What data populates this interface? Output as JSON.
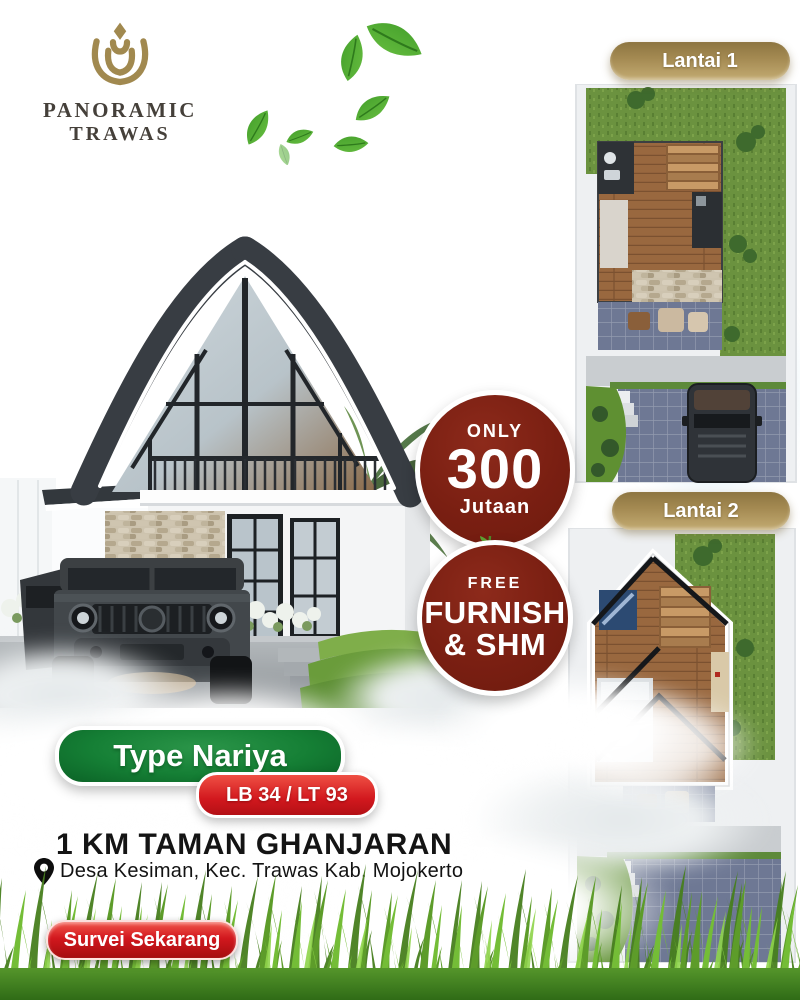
{
  "brand": {
    "line1": "PANORAMIC",
    "line2": "TRAWAS"
  },
  "floorplans": {
    "badge1": "Lantai 1",
    "badge2": "Lantai 2"
  },
  "price_badge": {
    "top": "ONLY",
    "amount": "300",
    "bottom": "Jutaan"
  },
  "promo_badge": {
    "top": "FREE",
    "line1": "FURNISH",
    "line2": "& SHM"
  },
  "type_badge": "Type Nariya",
  "spec_badge": "LB 34 / LT 93",
  "headline": "1 KM TAMAN GHANJARAN",
  "location": "Desa Kesiman, Kec. Trawas Kab. Mojokerto",
  "cta": "Survei Sekarang",
  "colors": {
    "logo_gold": "#a1894f",
    "badge_gold": "#a58b53",
    "maroon_circle": "#7a1f12",
    "green_pill": "#157f35",
    "red_pill": "#d2181e",
    "grass_green": "#5d9c2a",
    "headline_black": "#141414"
  }
}
